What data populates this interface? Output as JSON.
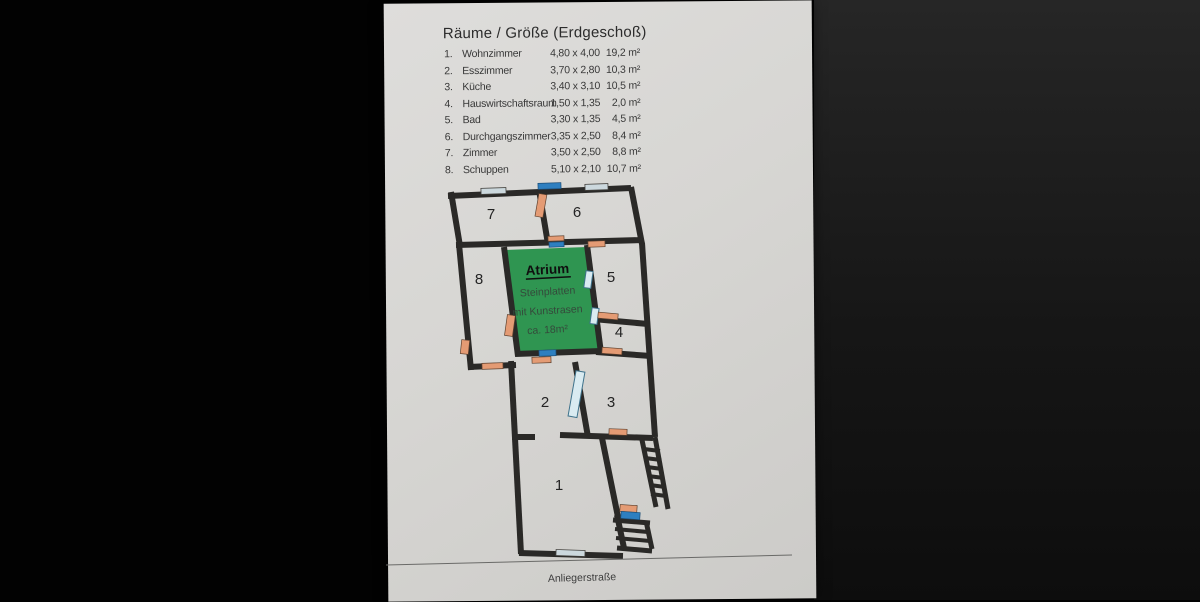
{
  "header": {
    "title": "Räume / Größe (Erdgeschoß)"
  },
  "room_list": [
    {
      "num": "1.",
      "name": "Wohnzimmer",
      "dims": "4,80 x 4,00",
      "area": "19,2 m²"
    },
    {
      "num": "2.",
      "name": "Esszimmer",
      "dims": "3,70 x 2,80",
      "area": "10,3 m²"
    },
    {
      "num": "3.",
      "name": "Küche",
      "dims": "3,40 x 3,10",
      "area": "10,5 m²"
    },
    {
      "num": "4.",
      "name": "Hauswirtschaftsraum",
      "dims": "1,50 x 1,35",
      "area": "2,0 m²"
    },
    {
      "num": "5.",
      "name": "Bad",
      "dims": "3,30 x 1,35",
      "area": "4,5 m²"
    },
    {
      "num": "6.",
      "name": "Durchgangszimmer",
      "dims": "3,35 x 2,50",
      "area": "8,4 m²"
    },
    {
      "num": "7.",
      "name": "Zimmer",
      "dims": "3,50 x 2,50",
      "area": "8,8 m²"
    },
    {
      "num": "8.",
      "name": "Schuppen",
      "dims": "5,10 x 2,10",
      "area": "10,7 m²"
    }
  ],
  "plan": {
    "rooms": {
      "r1": "1",
      "r2": "2",
      "r3": "3",
      "r4": "4",
      "r5": "5",
      "r6": "6",
      "r7": "7",
      "r8": "8"
    },
    "atrium": {
      "title": "Atrium",
      "line1": "Steinplatten",
      "line2": "mit Kunstrasen",
      "line3": "ca. 18m²"
    },
    "street": "Anliegerstraße",
    "colors": {
      "wall": "#2a2927",
      "atrium_green": "#2f9551",
      "door_orange": "#e49b74",
      "door_blue": "#2e7fc0",
      "glass_light": "#d9ebf1",
      "window_gray": "#ccd8dd",
      "paper": "#d7d6d3"
    }
  }
}
